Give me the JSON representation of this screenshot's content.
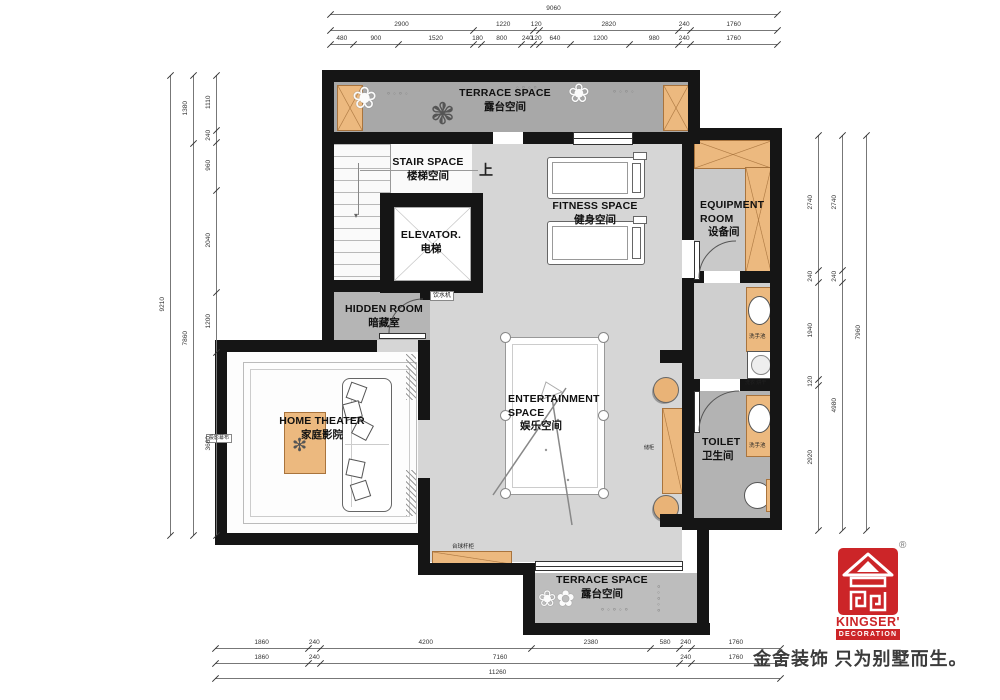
{
  "palette": {
    "wall": "#151515",
    "floor_main": "#d6d6d6",
    "floor_terrace": "#a8a8a8",
    "floor_dark": "#b3b3b3",
    "wood": "#ecb97f",
    "logo_red": "#cc2528"
  },
  "rooms": {
    "terrace_top": {
      "en": "TERRACE SPACE",
      "zh": "露台空间"
    },
    "stair": {
      "en": "STAIR SPACE",
      "zh": "楼梯空间"
    },
    "elevator": {
      "en": "ELEVATOR.",
      "zh": "电梯"
    },
    "fitness": {
      "en": "FITNESS SPACE",
      "zh": "健身空间"
    },
    "equipment": {
      "en": "EQUIPMENT ROOM",
      "zh": "设备间"
    },
    "hidden": {
      "en": "HIDDEN ROOM",
      "zh": "暗藏室"
    },
    "home_theater": {
      "en": "HOME THEATER",
      "zh": "家庭影院"
    },
    "entertainment": {
      "en": "ENTERTAINMENT SPACE",
      "zh": "娱乐空间"
    },
    "toilet": {
      "en": "TOILET",
      "zh": "卫生间"
    },
    "terrace_bottom": {
      "en": "TERRACE SPACE",
      "zh": "露台空间"
    }
  },
  "annotations": {
    "up": "上",
    "water_dispenser": "饮水机",
    "projection_screen": "投影幕布",
    "basin_top": "洗手池",
    "basin_bottom": "洗手池",
    "laundry": "洗衣 烘干",
    "cue_cabinet": "台球杆柜",
    "side_cabinet": "储柜"
  },
  "logo": {
    "brand": "KINGSER'",
    "sub": "DECORATION",
    "registered": "®",
    "tagline": "金舍装饰 只为别墅而生。"
  },
  "dimensions": {
    "chains": [
      {
        "id": "top-total",
        "orient": "h",
        "x": 330,
        "y": 14,
        "len": 447,
        "values": [
          9060
        ]
      },
      {
        "id": "top-mid",
        "orient": "h",
        "x": 330,
        "y": 30,
        "len": 447,
        "values": [
          2900,
          1220,
          120,
          2820,
          240,
          1760
        ]
      },
      {
        "id": "top-detail",
        "orient": "h",
        "x": 330,
        "y": 44,
        "len": 447,
        "values": [
          480,
          900,
          1520,
          180,
          800,
          240,
          120,
          640,
          1200,
          980,
          240,
          1760
        ]
      },
      {
        "id": "left-total",
        "orient": "v",
        "x": 170,
        "y": 75,
        "len": 460,
        "values": [
          9210
        ]
      },
      {
        "id": "left-mid",
        "orient": "v",
        "x": 193,
        "y": 75,
        "len": 460,
        "values": [
          1380,
          7860
        ]
      },
      {
        "id": "left-detail",
        "orient": "v",
        "x": 216,
        "y": 75,
        "len": 460,
        "values": [
          1110,
          240,
          960,
          2040,
          1200,
          3660
        ]
      },
      {
        "id": "right-detail",
        "orient": "v",
        "x": 818,
        "y": 135,
        "len": 395,
        "values": [
          2740,
          240,
          1940,
          120,
          2920
        ]
      },
      {
        "id": "right-mid",
        "orient": "v",
        "x": 842,
        "y": 135,
        "len": 395,
        "values": [
          2740,
          240,
          4980
        ]
      },
      {
        "id": "right-total",
        "orient": "v",
        "x": 866,
        "y": 135,
        "len": 395,
        "values": [
          7960
        ]
      },
      {
        "id": "bottom-detail",
        "orient": "h",
        "x": 215,
        "y": 648,
        "len": 565,
        "values": [
          1860,
          240,
          4200,
          2380,
          580,
          240,
          1760
        ]
      },
      {
        "id": "bottom-mid",
        "orient": "h",
        "x": 215,
        "y": 663,
        "len": 565,
        "values": [
          1860,
          240,
          7160,
          240,
          1760
        ]
      },
      {
        "id": "bottom-total",
        "orient": "h",
        "x": 215,
        "y": 678,
        "len": 565,
        "values": [
          11260
        ]
      }
    ]
  }
}
